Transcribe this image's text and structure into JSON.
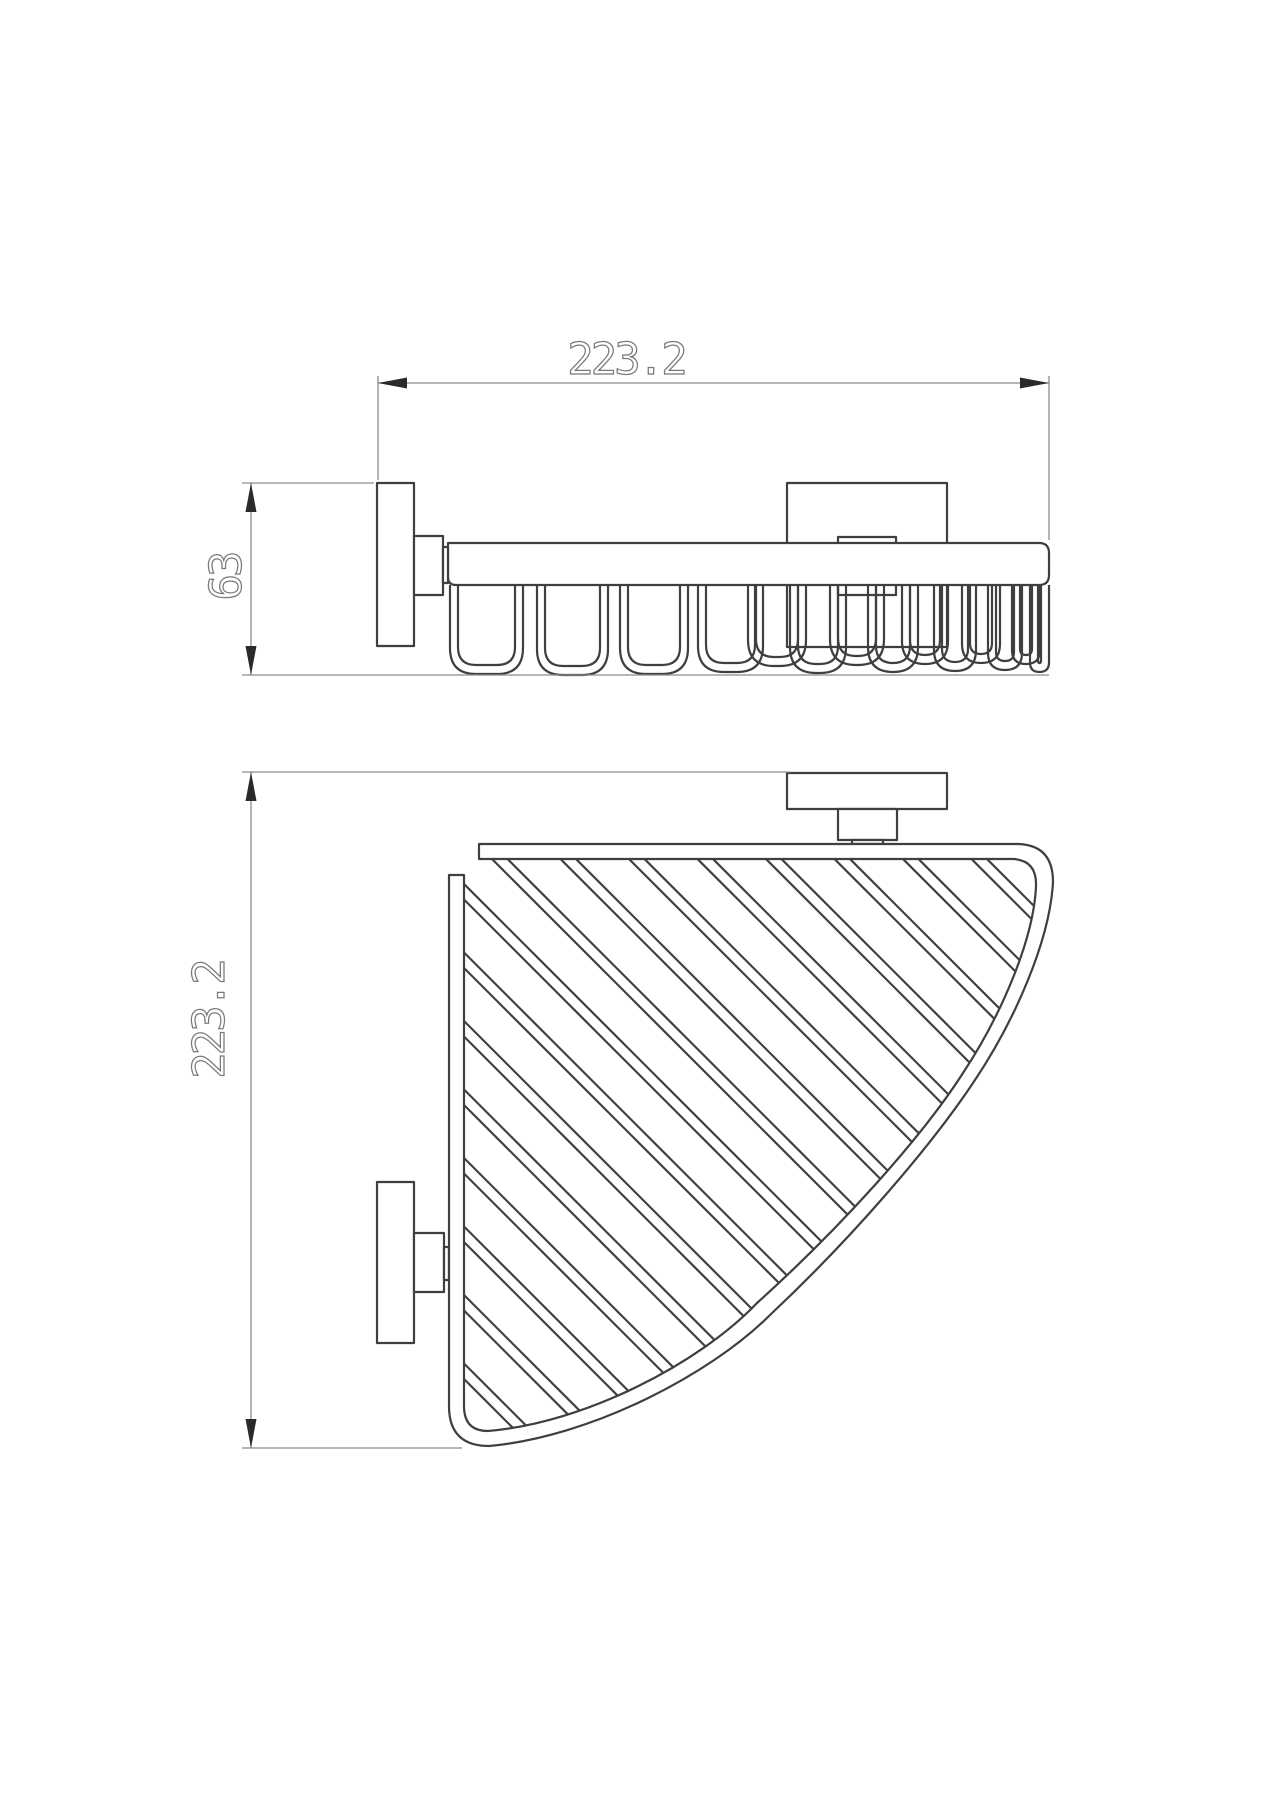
{
  "title": "Corner wire basket - technical drawing",
  "colors": {
    "background": "#ffffff",
    "object_line": "#3f3f3f",
    "dimension_line": "#8c8c8c",
    "arrow": "#2a2a2a",
    "dimension_text": "#7a7a7a"
  },
  "front_view": {
    "width_label": "223.2",
    "height_label": "63"
  },
  "plan_view": {
    "depth_label": "223.2"
  }
}
